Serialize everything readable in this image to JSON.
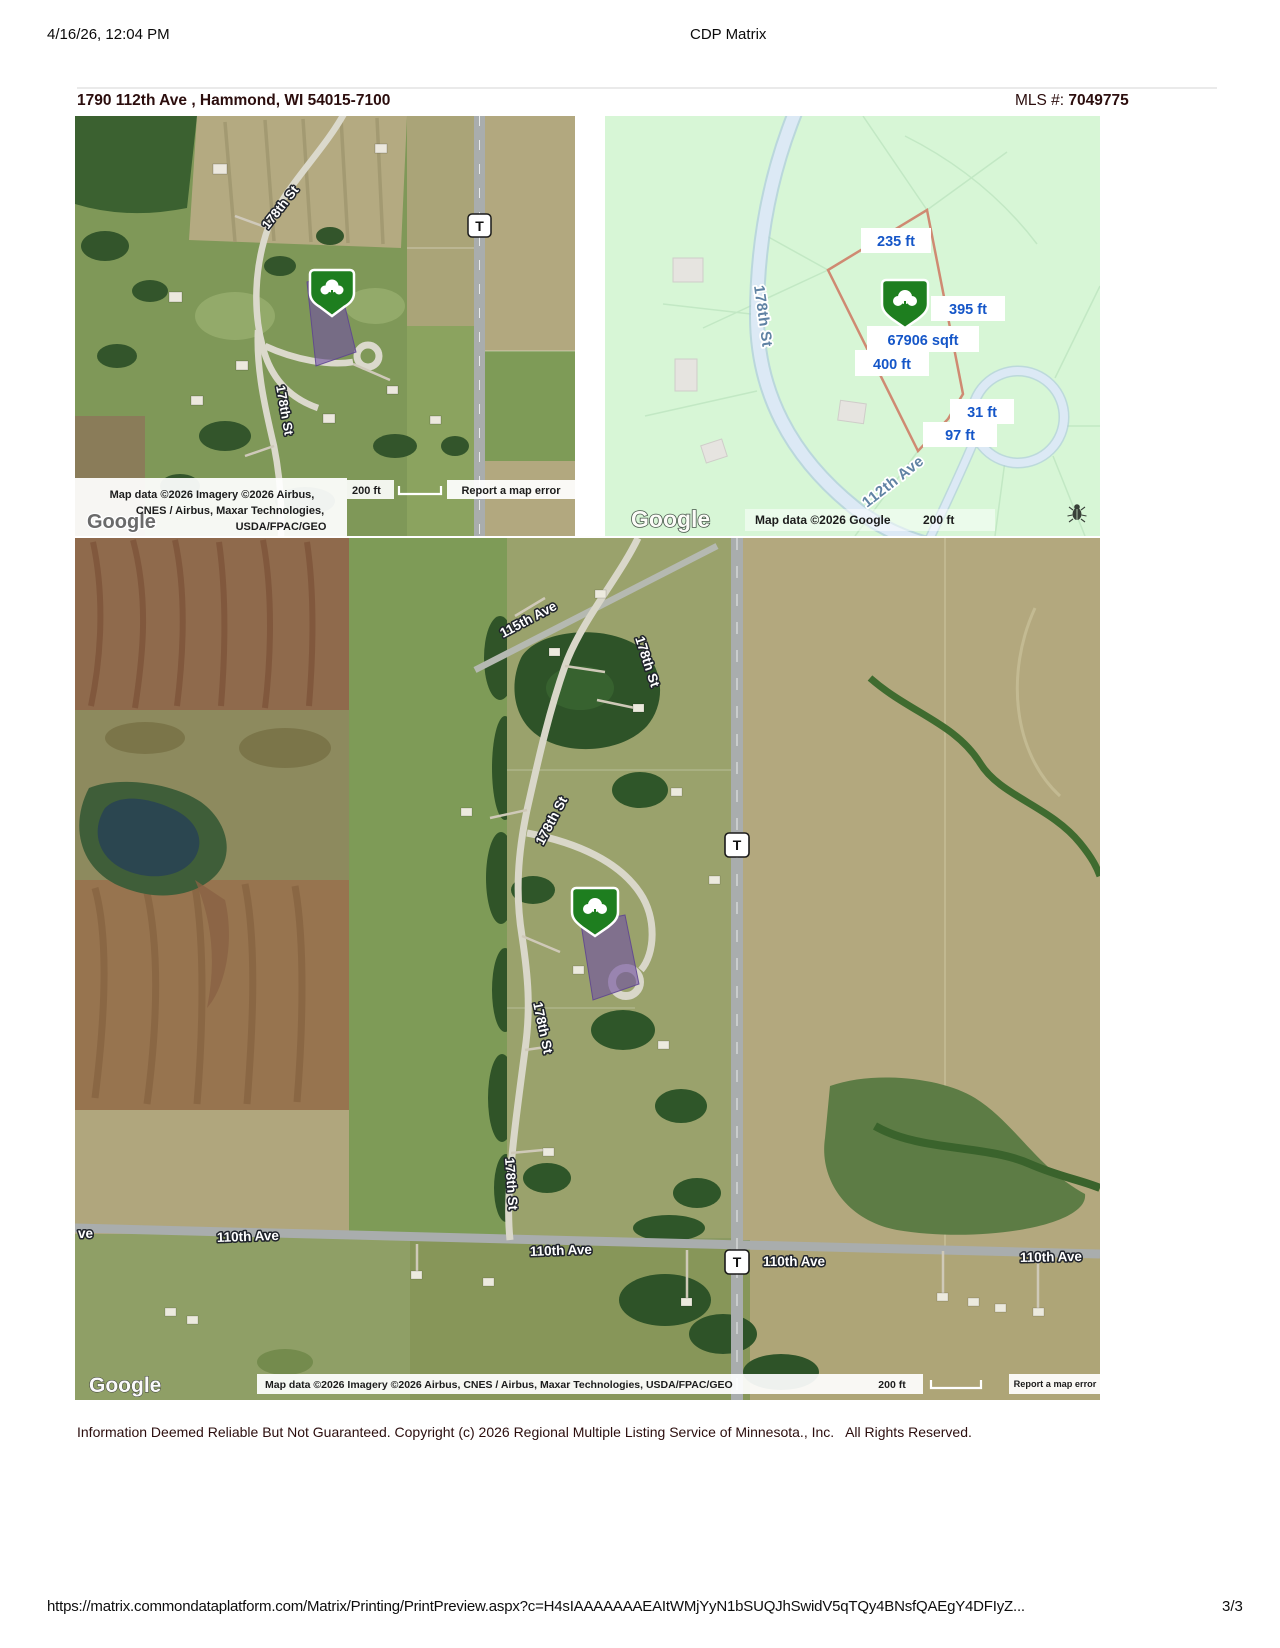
{
  "header": {
    "timestamp": "4/16/26, 12:04 PM",
    "title": "CDP Matrix"
  },
  "listing": {
    "address": "1790 112th Ave , Hammond, WI 54015-7100",
    "mls_label": "MLS #:",
    "mls_number": "7049775"
  },
  "map_small": {
    "label_178_upper": "178th St",
    "label_178_lower": "178th St",
    "shield": "T",
    "attr_line1": "Map data ©2026 Imagery ©2026 Airbus,",
    "attr_line2": "CNES / Airbus, Maxar Technologies,",
    "attr_line3": "USDA/FPAC/GEO",
    "scale": "200 ft",
    "report": "Report a map error",
    "logo": "Google"
  },
  "map_parcel": {
    "label_178": "178th St",
    "label_112": "112th Ave",
    "dim_top": "235 ft",
    "dim_right": "395 ft",
    "dim_area": "67906 sqft",
    "dim_left": "400 ft",
    "dim_right2": "31 ft",
    "dim_bottom": "97 ft",
    "attribution": "Map data ©2026 Google",
    "scale": "200 ft",
    "logo": "Google"
  },
  "map_large": {
    "label_115": "115th Ave",
    "label_178_a": "178th St",
    "label_178_b": "178th St",
    "label_178_c": "178th St",
    "label_178_d": "178th St",
    "label_110_a": "110th Ave",
    "label_110_b": "110th Ave",
    "label_110_c": "110th Ave",
    "label_110_d": "110th Ave",
    "label_110_partial": "ve",
    "shield": "T",
    "attribution": "Map data ©2026 Imagery ©2026 Airbus, CNES / Airbus, Maxar Technologies, USDA/FPAC/GEO",
    "scale": "200 ft",
    "report": "Report a map error",
    "logo": "Google"
  },
  "footer": {
    "disclaimer": "Information Deemed Reliable But Not Guaranteed. Copyright (c) 2026 Regional Multiple Listing Service of Minnesota., Inc.   All Rights Reserved.",
    "url": "https://matrix.commondataplatform.com/Matrix/Printing/PrintPreview.aspx?c=H4sIAAAAAAAEAItWMjYyN1bSUQJhSwidV5qTQy4BNsfQAEgY4DFIyZ...",
    "page": "3/3"
  }
}
